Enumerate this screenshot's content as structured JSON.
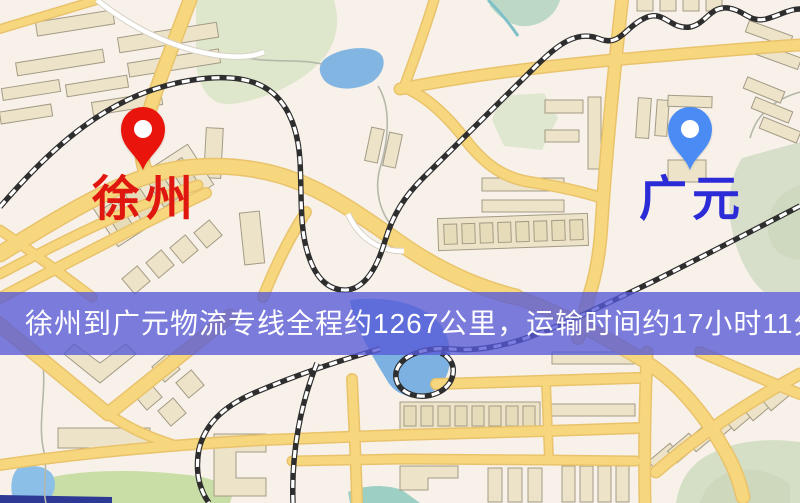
{
  "banner": {
    "text": "徐州到广元物流专线全程约1267公里，运输时间约17小时11分钟.",
    "background_color": "#565ad7",
    "text_color": "#ffffff"
  },
  "route_info": {
    "origin": "徐州",
    "destination": "广元",
    "service": "物流专线",
    "distance_text": "约1267公里",
    "duration_text": "约17小时11分钟"
  },
  "markers": {
    "origin": {
      "name": "徐州",
      "pin_color": "#e9150c",
      "pin_inner_color": "#ffffff",
      "label_color": "#e0170f"
    },
    "destination": {
      "name": "广元",
      "pin_color": "#4a8cf4",
      "pin_inner_color": "#ffffff",
      "label_color": "#2b2bd8"
    }
  },
  "map_colors": {
    "background": "#f8f1e9",
    "road_major": "#f7d77e",
    "road_casing": "#e9c36b",
    "road_minor": "#ffffff",
    "park_green": "#dce5c9",
    "water_blue": "#82b5e2",
    "railway_dark": "#2e2e2e",
    "building_fill": "#ece3c8",
    "building_stroke": "#a39b85"
  }
}
